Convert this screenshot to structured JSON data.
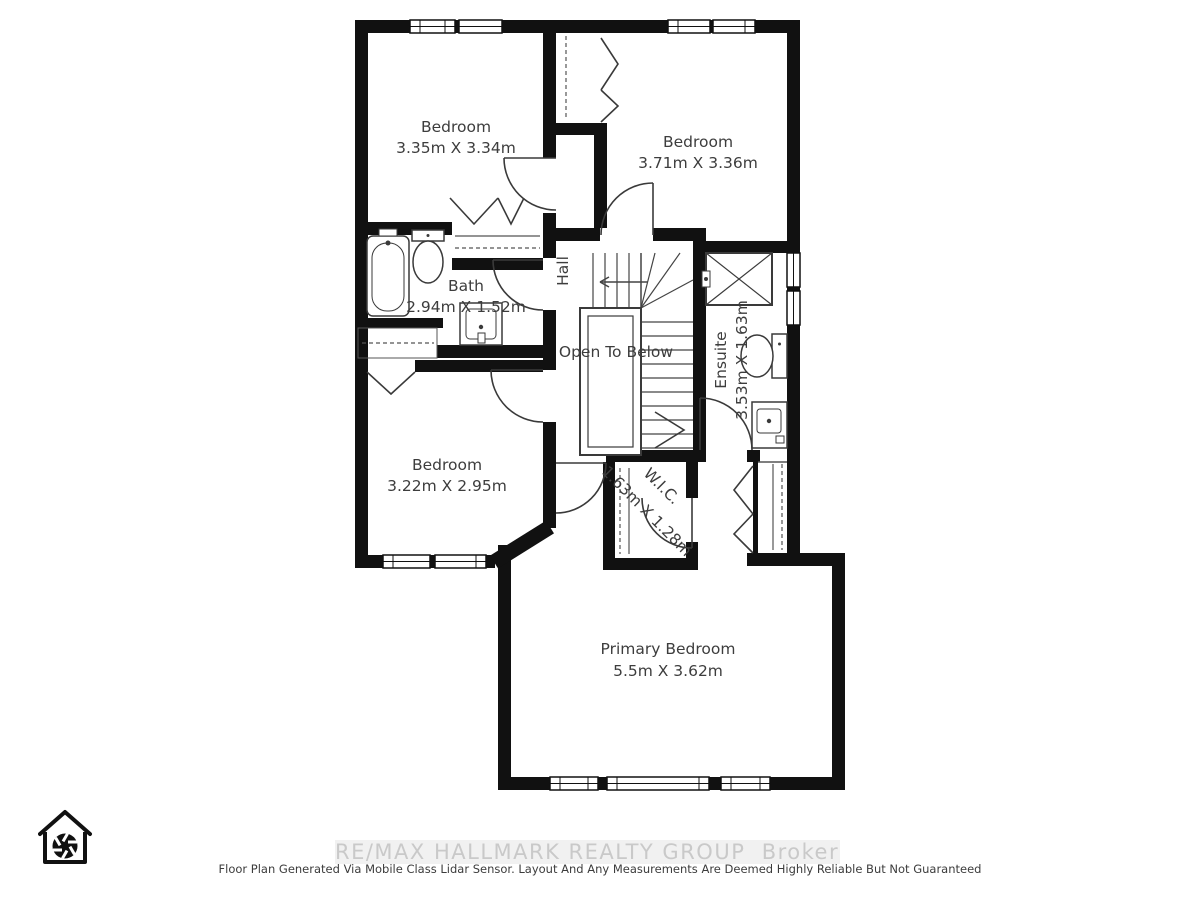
{
  "floorplan": {
    "rooms": {
      "bedroom_top_left": {
        "label": "Bedroom",
        "dims": "3.35m X 3.34m"
      },
      "bedroom_top_right": {
        "label": "Bedroom",
        "dims": "3.71m X 3.36m"
      },
      "bath": {
        "label": "Bath",
        "dims": "2.94m X 1.52m"
      },
      "hall": {
        "label": "Hall"
      },
      "open_to_below": {
        "label": "Open To Below"
      },
      "ensuite": {
        "label": "Ensuite",
        "dims": "3.53m X 1.63m"
      },
      "bedroom_mid_left": {
        "label": "Bedroom",
        "dims": "3.22m X 2.95m"
      },
      "wic": {
        "label": "W.I.C.",
        "dims": "1.63m X 1.28m"
      },
      "primary_bedroom": {
        "label": "Primary Bedroom",
        "dims": "5.5m X 3.62m"
      }
    }
  },
  "footer": {
    "watermark": "RE/MAX HALLMARK REALTY GROUP  Brokerage",
    "disclaimer": "Floor Plan Generated Via Mobile Class Lidar Sensor. Layout And Any Measurements Are Deemed Highly Reliable But Not Guaranteed"
  },
  "icons": {
    "logo": "house-camera-aperture-icon"
  },
  "colors": {
    "wall": "#111111",
    "fixture": "#3a3a3a",
    "label": "#3d3d3d",
    "watermark_text": "#c9c9c9",
    "watermark_bg": "#f1f1f1",
    "disclaimer": "#3c3c3c"
  }
}
